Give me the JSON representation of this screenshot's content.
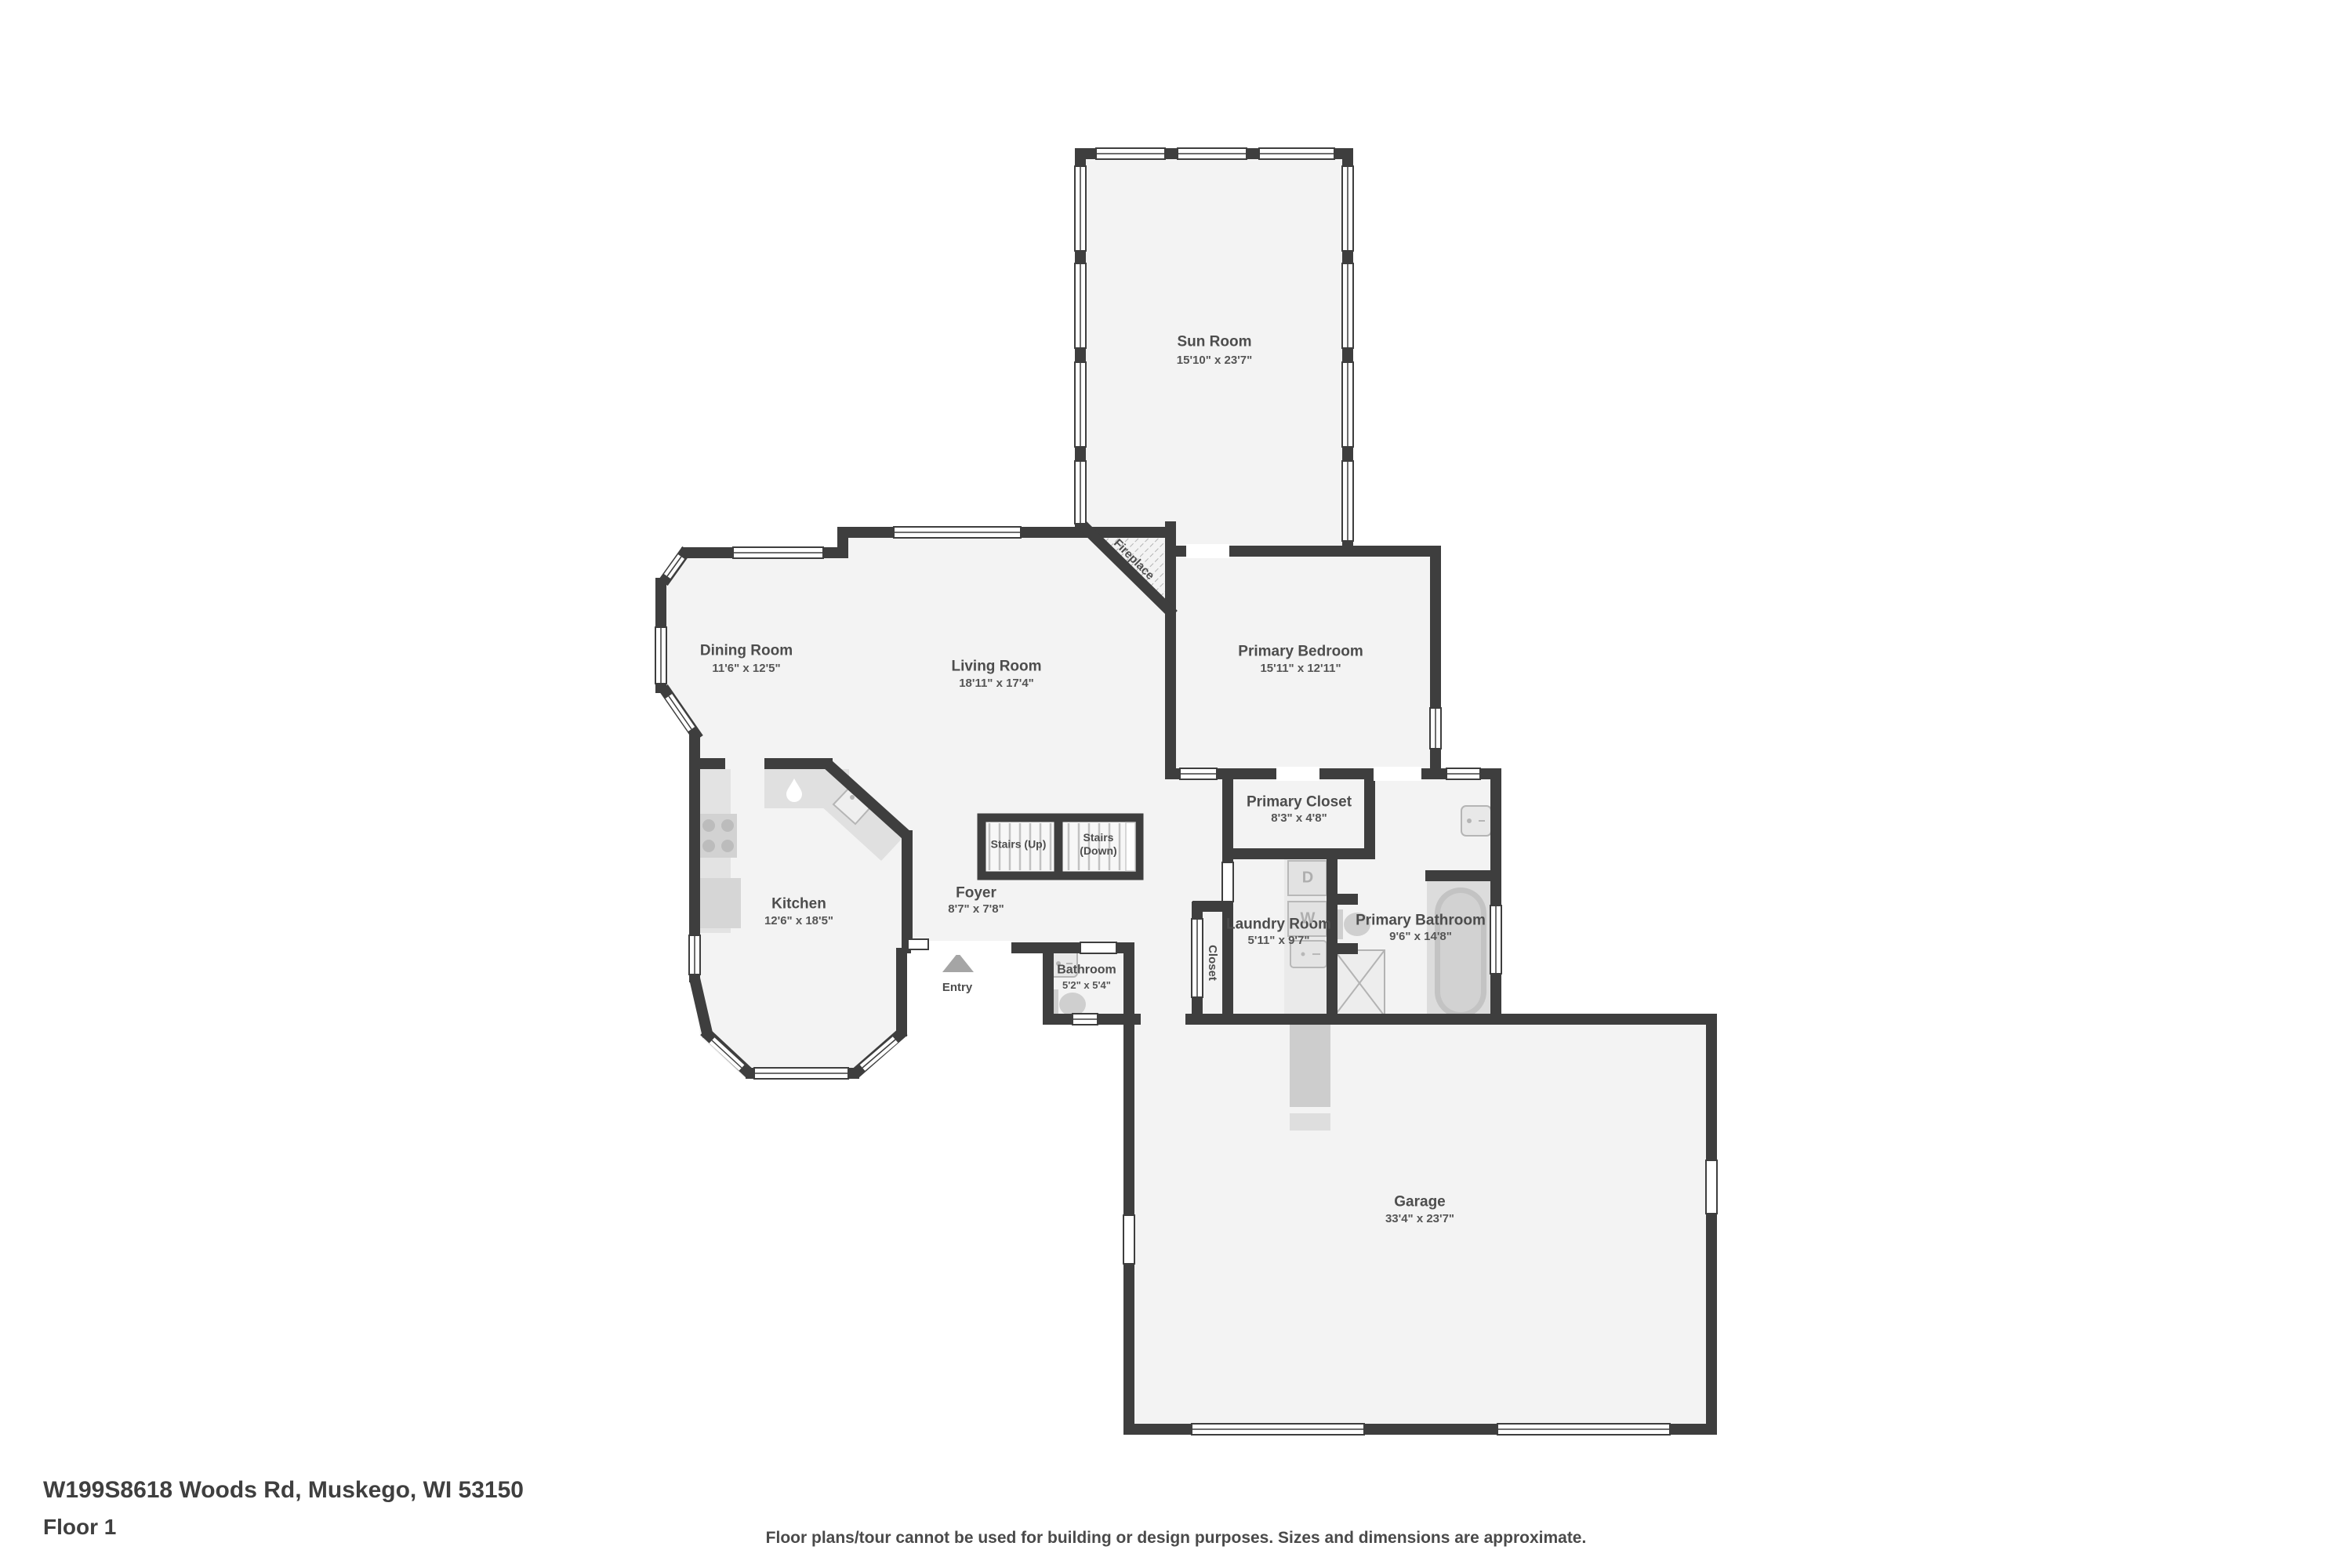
{
  "footer": {
    "address": "W199S8618 Woods Rd, Muskego, WI 53150",
    "floor_label": "Floor 1",
    "disclaimer": "Floor plans/tour cannot be used for building or design purposes. Sizes and dimensions are approximate."
  },
  "rooms": {
    "sun_room": {
      "name": "Sun Room",
      "dims": "15'10\" x 23'7\""
    },
    "dining_room": {
      "name": "Dining Room",
      "dims": "11'6\" x 12'5\""
    },
    "living_room": {
      "name": "Living Room",
      "dims": "18'11\" x 17'4\""
    },
    "primary_bedroom": {
      "name": "Primary Bedroom",
      "dims": "15'11\" x 12'11\""
    },
    "primary_closet": {
      "name": "Primary Closet",
      "dims": "8'3\" x 4'8\""
    },
    "kitchen": {
      "name": "Kitchen",
      "dims": "12'6\" x 18'5\""
    },
    "foyer": {
      "name": "Foyer",
      "dims": "8'7\" x 7'8\""
    },
    "bathroom": {
      "name": "Bathroom",
      "dims": "5'2\" x 5'4\""
    },
    "laundry_room": {
      "name": "Laundry Room",
      "dims": "5'11\" x 9'7\""
    },
    "primary_bathroom": {
      "name": "Primary Bathroom",
      "dims": "9'6\" x 14'8\""
    },
    "garage": {
      "name": "Garage",
      "dims": "33'4\" x 23'7\""
    }
  },
  "annotations": {
    "stairs_up": "Stairs (Up)",
    "stairs_down_line1": "Stairs",
    "stairs_down_line2": "(Down)",
    "fireplace": "Fireplace",
    "entry": "Entry",
    "closet": "Closet",
    "washer": "W",
    "dryer": "D"
  },
  "colors": {
    "wall": "#3e3e3e",
    "room_fill": "#f3f3f3",
    "fixture_fill": "#d6d6d6",
    "text": "#4d4d4d"
  }
}
